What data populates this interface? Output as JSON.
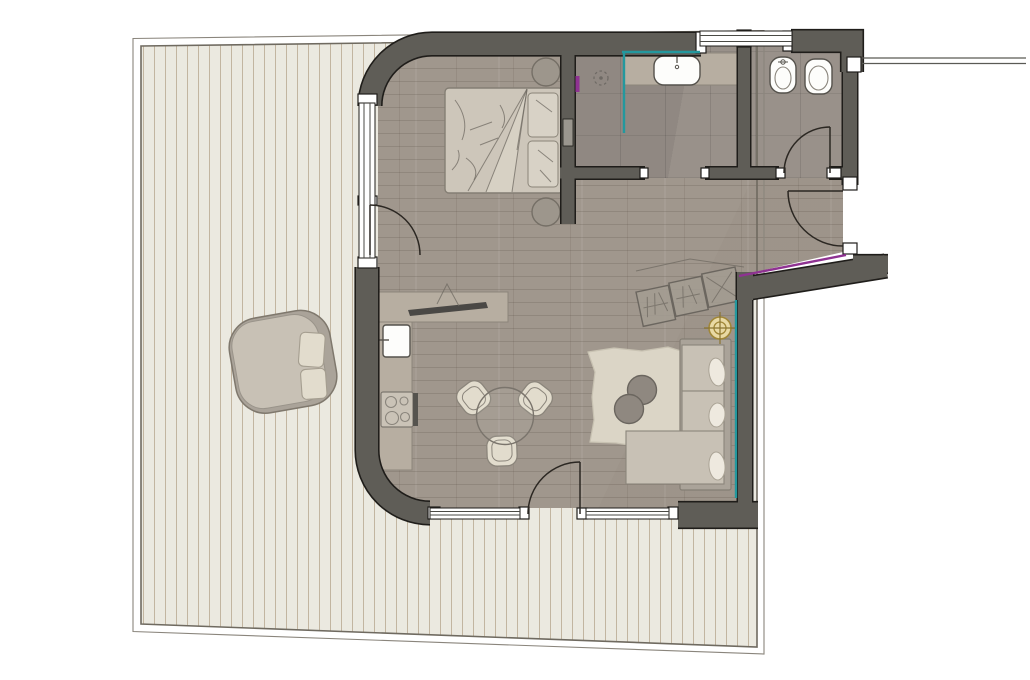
{
  "figure": {
    "type": "architectural-floor-plan",
    "title": "Studio apartment plan with wrap-around timber terrace",
    "visible_text": []
  },
  "rooms": [
    {
      "id": "terrace",
      "label": "timber deck terrace",
      "floor": "vertical wood planks"
    },
    {
      "id": "living-kitchen",
      "label": "open living / kitchen / sleeping space",
      "floor": "wood planks"
    },
    {
      "id": "bathroom",
      "label": "shower bathroom",
      "floor": "stone tile"
    },
    {
      "id": "wc",
      "label": "separate WC",
      "floor": "stone tile"
    },
    {
      "id": "entry-vestibule",
      "label": "entry with wardrobe",
      "floor": "wood planks"
    }
  ],
  "furniture": [
    {
      "id": "bed",
      "label": "double bed with duvet and two pillows"
    },
    {
      "id": "nightstand-top",
      "label": "round side table"
    },
    {
      "id": "nightstand-bottom",
      "label": "round side table"
    },
    {
      "id": "kitchen-counter",
      "label": "L-shaped kitchen counter"
    },
    {
      "id": "kitchen-sink",
      "label": "kitchen sink"
    },
    {
      "id": "cooktop",
      "label": "4-burner cooktop"
    },
    {
      "id": "tv-sideboard",
      "label": "sideboard with TV on swivel bracket"
    },
    {
      "id": "dining-table",
      "label": "round glass dining table"
    },
    {
      "id": "dining-chairs",
      "label": "three dining chairs",
      "count": 3
    },
    {
      "id": "sofa",
      "label": "L-shaped sofa with three cushions"
    },
    {
      "id": "coffee-tables",
      "label": "two overlapping round coffee tables",
      "count": 2
    },
    {
      "id": "rug",
      "label": "area rug"
    },
    {
      "id": "wardrobe",
      "label": "three-module entry wardrobe"
    },
    {
      "id": "outdoor-lounge-chair",
      "label": "terrace lounge chair with cushions"
    },
    {
      "id": "bathroom-counter",
      "label": "vanity counter"
    },
    {
      "id": "bathroom-sink",
      "label": "washbasin"
    },
    {
      "id": "shower",
      "label": "walk-in shower with glass screen and floor drain"
    },
    {
      "id": "bidet",
      "label": "bidet"
    },
    {
      "id": "toilet",
      "label": "toilet"
    }
  ],
  "openings": [
    {
      "id": "window-left",
      "label": "glazed wall with terrace door (west)"
    },
    {
      "id": "window-bottom",
      "label": "glazed wall with terrace door (south)"
    },
    {
      "id": "window-top",
      "label": "bathroom / WC window"
    },
    {
      "id": "door-entry",
      "label": "apartment entry door"
    },
    {
      "id": "door-wc",
      "label": "WC door"
    },
    {
      "id": "doorway-bathroom",
      "label": "open bathroom doorway"
    }
  ],
  "symbols": [
    {
      "id": "ceiling-light-symbol",
      "label": "ceiling light / survey point",
      "color": "#a18738"
    },
    {
      "id": "shower-drain",
      "label": "floor drain"
    },
    {
      "id": "glazing-marker-teal",
      "label": "glass screen markers",
      "color": "#23989e"
    },
    {
      "id": "wall-marker-purple",
      "label": "wall finish marker",
      "color": "#8f3292"
    },
    {
      "id": "property-boundary-line",
      "label": "boundary line to the east"
    }
  ],
  "palette": {
    "ink": "#1f1d1a",
    "wall": "#5f5d57",
    "floor-wood": "#a0978d",
    "tile": "#99918a",
    "deck": "#ebe9e0",
    "deck-line": "#c2b5a0",
    "deck-edge": "#6f6a60",
    "counter": "#b7aea1",
    "fixture-white": "#fdfdfb",
    "fixture-line": "#55524c",
    "furn-light": "#c8c1b5",
    "furn-mid": "#aaa399",
    "furn-dark": "#8f8880",
    "cream": "#e2dccd",
    "rug": "#dbd5c6",
    "bed-fill": "#cdc6ba",
    "sketch": "#6f6962",
    "teal": "#23989e",
    "purple": "#8f3292",
    "gold-fill": "#e9d9a4",
    "gold-line": "#a18738",
    "arc": "#2b2722",
    "glass-line": "#4a4a45",
    "boundary": "#5a5a55"
  }
}
